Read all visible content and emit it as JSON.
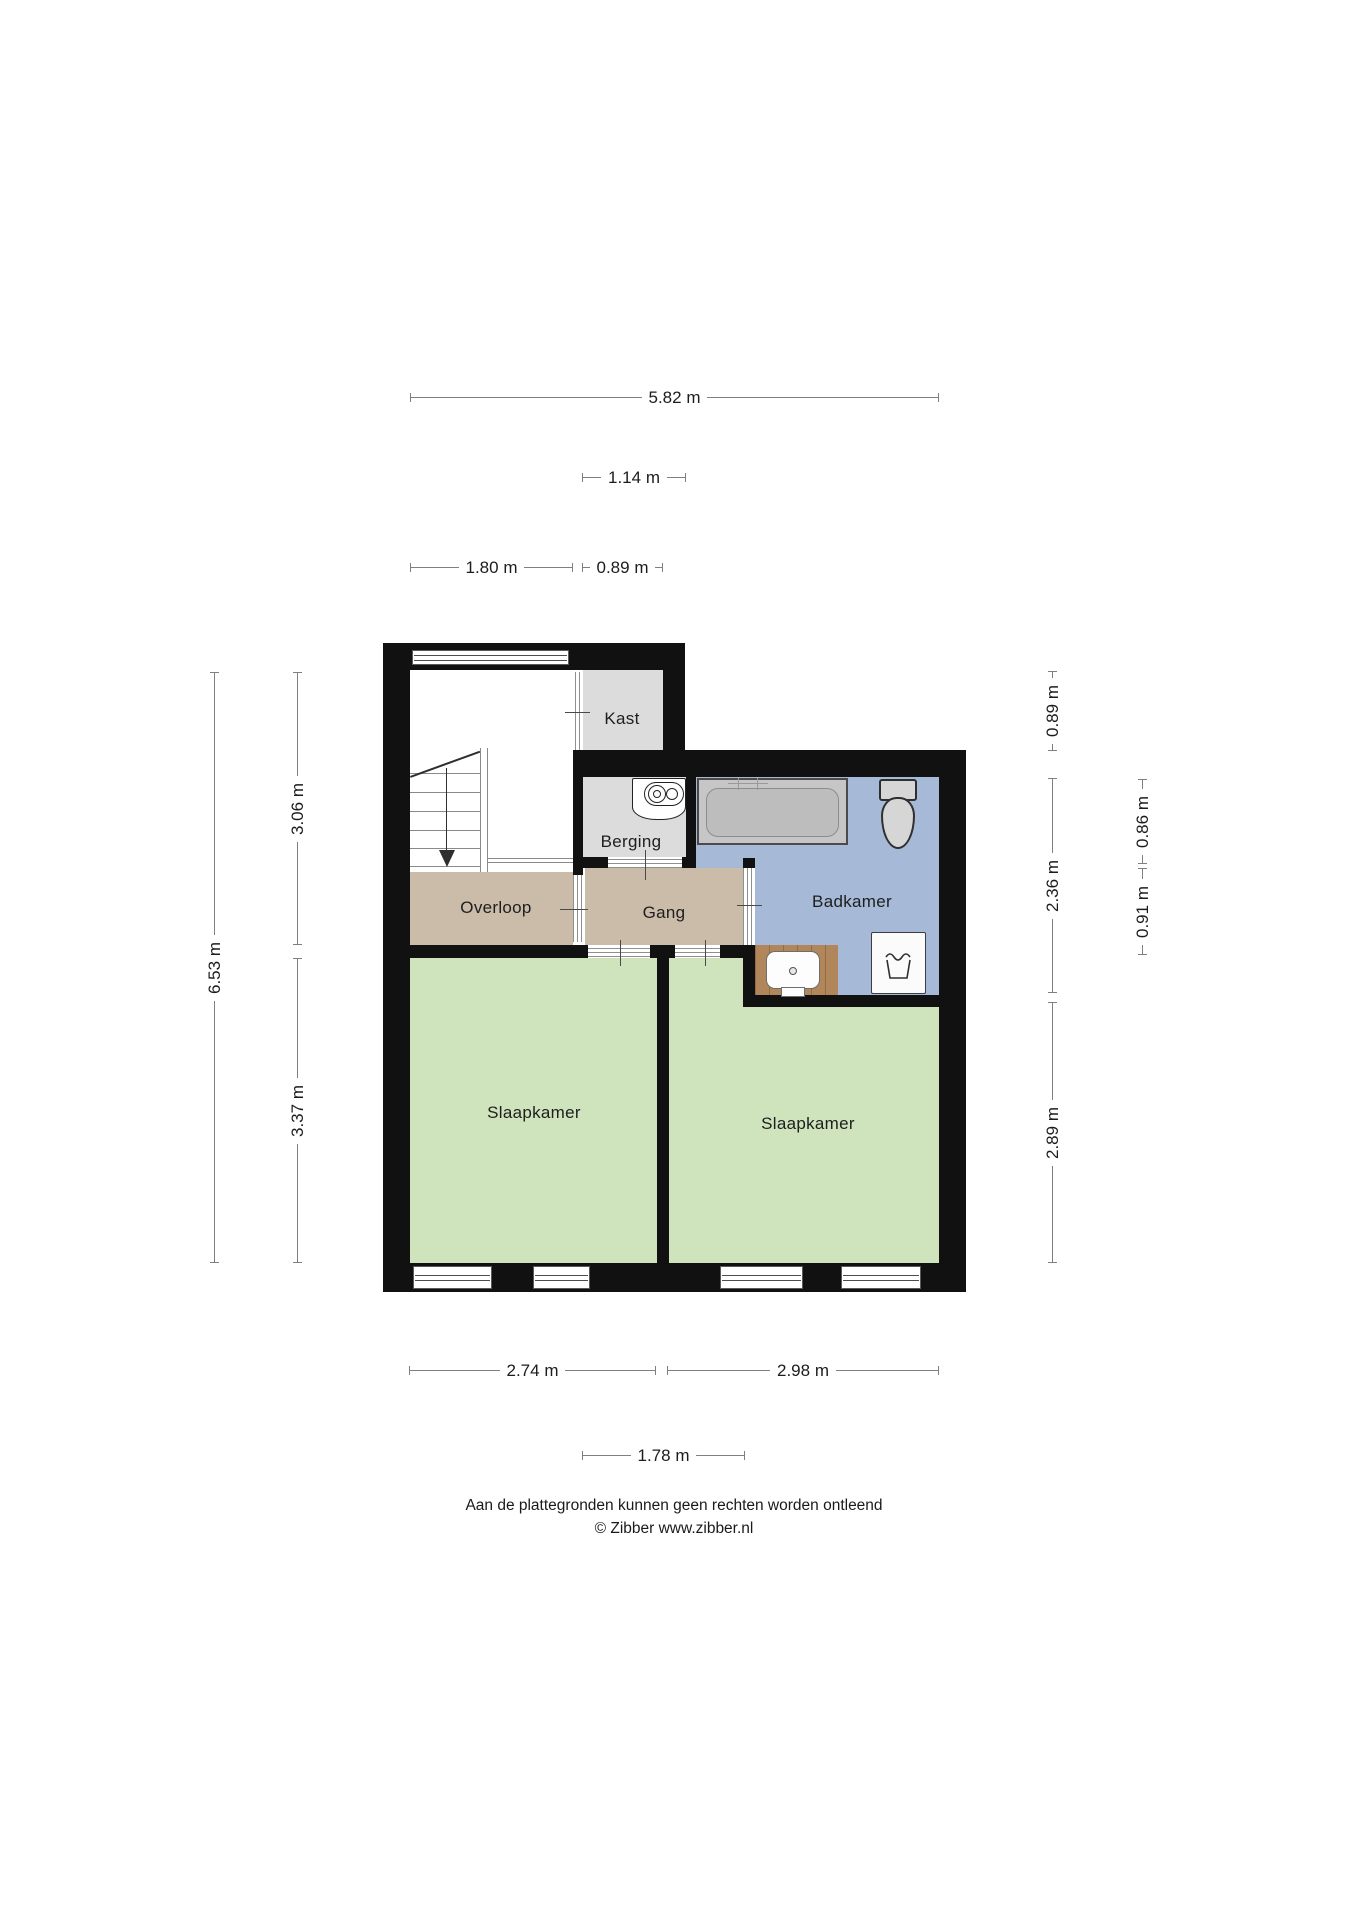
{
  "floorplan": {
    "type": "floor-plan",
    "source": "© Zibber www.zibber.nl",
    "rooms": [
      {
        "id": "kast",
        "label": "Kast"
      },
      {
        "id": "berging",
        "label": "Berging"
      },
      {
        "id": "overloop",
        "label": "Overloop"
      },
      {
        "id": "gang",
        "label": "Gang"
      },
      {
        "id": "badkamer",
        "label": "Badkamer"
      },
      {
        "id": "slaapkamer-left",
        "label": "Slaapkamer"
      },
      {
        "id": "slaapkamer-right",
        "label": "Slaapkamer"
      }
    ],
    "dimensions": {
      "top": [
        {
          "label": "5.82 m"
        },
        {
          "label": "1.14 m"
        },
        {
          "label": "1.80 m"
        },
        {
          "label": "0.89 m"
        }
      ],
      "left": [
        {
          "label": "6.53 m"
        },
        {
          "label": "3.06 m"
        },
        {
          "label": "3.37 m"
        }
      ],
      "right": [
        {
          "label": "0.89 m"
        },
        {
          "label": "2.36 m"
        },
        {
          "label": "2.89 m"
        },
        {
          "label": "0.86 m"
        },
        {
          "label": "0.91 m"
        }
      ],
      "bottom": [
        {
          "label": "2.74 m"
        },
        {
          "label": "2.98 m"
        },
        {
          "label": "1.78 m"
        }
      ]
    },
    "fixtures": [
      "stairs",
      "boiler",
      "bathtub",
      "toilet",
      "washbasin",
      "washing-machine"
    ],
    "colors": {
      "wall": "#111111",
      "bedroom-floor": "#cfe4bc",
      "hallway-floor": "#cbbca9",
      "bathroom-floor": "#a6b9d7",
      "storage-floor": "#dcdcdc",
      "wood-floor": "#b2865b",
      "background": "#ffffff"
    },
    "footer": {
      "line1": "Aan de plattegronden kunnen geen rechten worden ontleend",
      "line2": "© Zibber www.zibber.nl"
    }
  }
}
